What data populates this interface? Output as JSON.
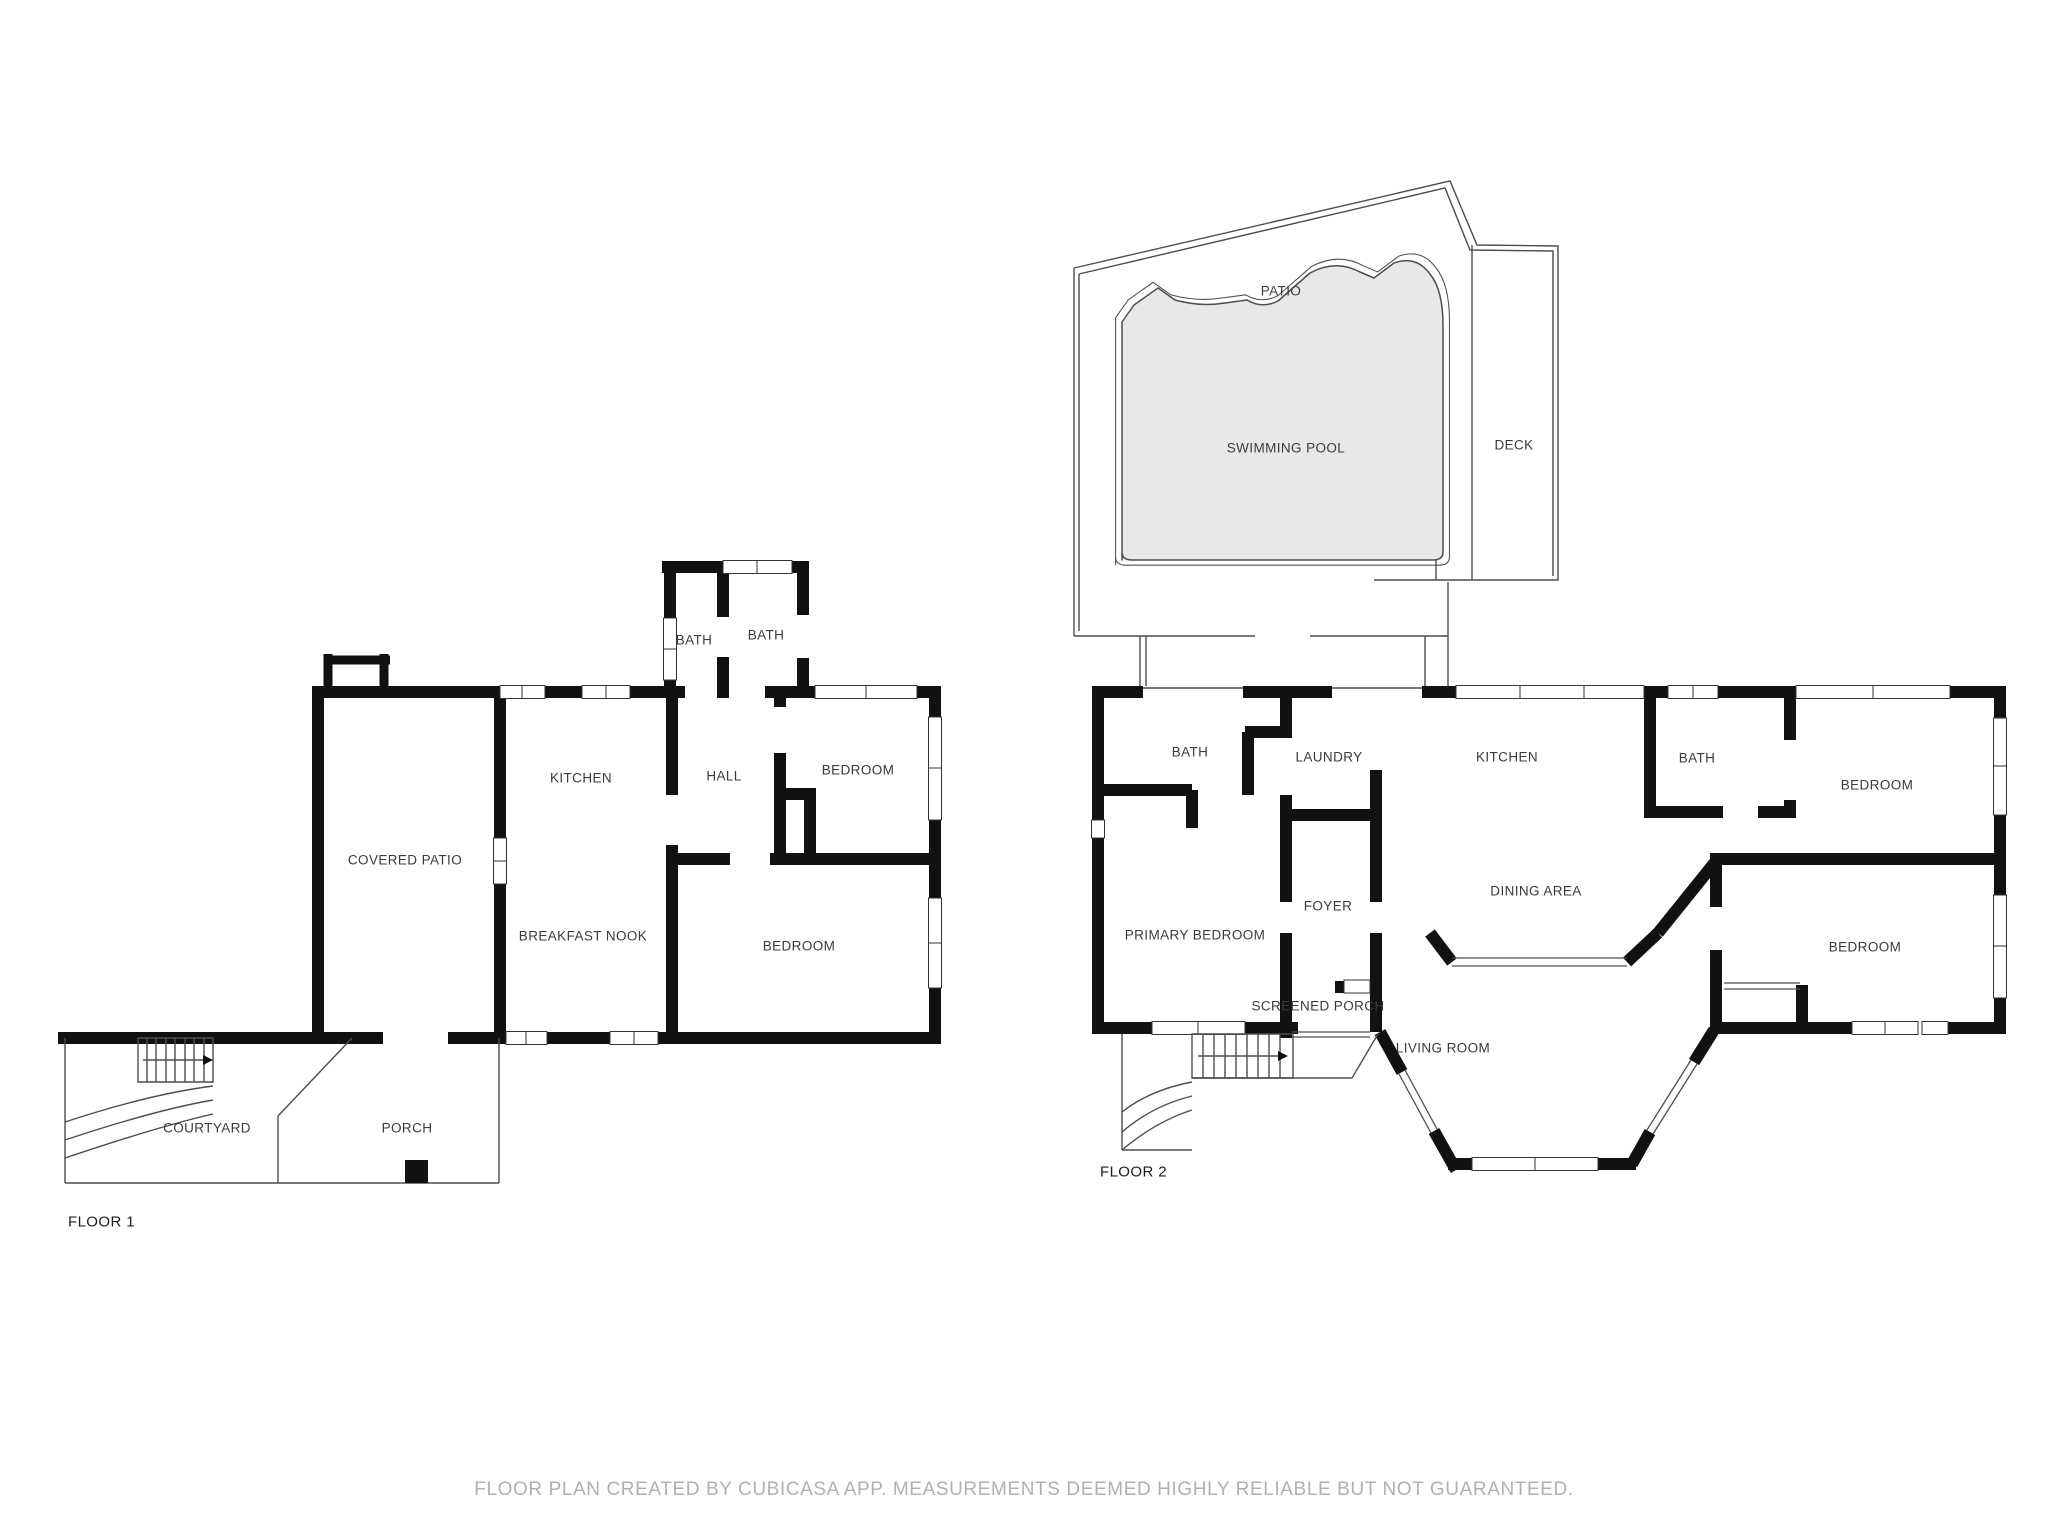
{
  "footer": {
    "disclaimer": "FLOOR PLAN CREATED BY CUBICASA APP. MEASUREMENTS DEEMED HIGHLY RELIABLE BUT NOT GUARANTEED."
  },
  "pool_area": {
    "patio": "PATIO",
    "swimming_pool": "SWIMMING POOL",
    "deck": "DECK"
  },
  "floor1": {
    "label": "FLOOR 1",
    "rooms": {
      "covered_patio": "COVERED PATIO",
      "kitchen": "KITCHEN",
      "bath_a": "BATH",
      "bath_b": "BATH",
      "hall": "HALL",
      "bedroom_top": "BEDROOM",
      "breakfast_nook": "BREAKFAST NOOK",
      "bedroom_bottom": "BEDROOM",
      "courtyard": "COURTYARD",
      "porch": "PORCH"
    }
  },
  "floor2": {
    "label": "FLOOR 2",
    "rooms": {
      "bath_left": "BATH",
      "laundry": "LAUNDRY",
      "kitchen": "KITCHEN",
      "bath_right": "BATH",
      "bedroom_top": "BEDROOM",
      "primary_bedroom": "PRIMARY BEDROOM",
      "foyer": "FOYER",
      "dining_area": "DINING AREA",
      "bedroom_bottom": "BEDROOM",
      "screened_porch": "SCREENED PORCH",
      "living_room": "LIVING ROOM"
    }
  },
  "colors": {
    "wall": "#111111",
    "thin_line": "#4d4d4d",
    "pool_fill": "#e8e8e8",
    "label_text": "#3b3b3b",
    "footer_text": "#b0b0b0"
  }
}
